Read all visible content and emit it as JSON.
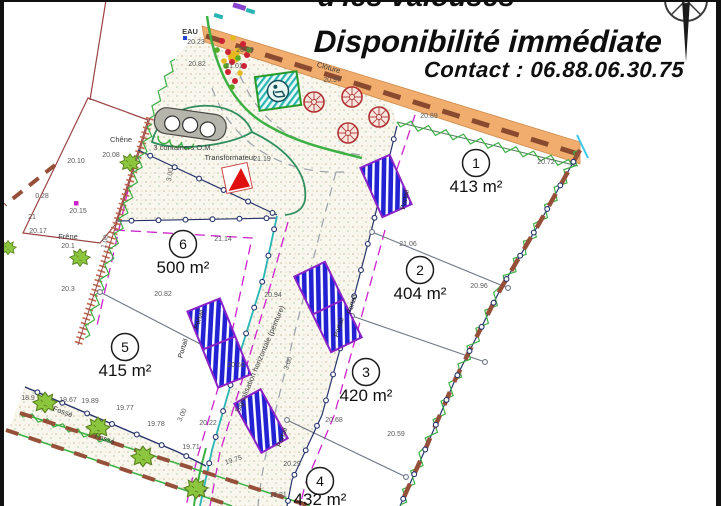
{
  "header": {
    "line1": "d'les valouses",
    "line2": "Disponibilité immédiate",
    "contact": "Contact : 06.88.06.30.75"
  },
  "colors": {
    "road_band": "#f0ad6e",
    "hedge_green": "#3cb043",
    "gate_blue": "#2222d4",
    "gate_border": "#8a22c8",
    "setback_magenta": "#cc22cc",
    "curb_teal": "#2ab5b5",
    "tree_red": "#b03030",
    "transformer_red": "#e01010",
    "fence_brown": "#96503a",
    "boundary_navy": "#26336b"
  },
  "plan": {
    "lots": [
      {
        "num": "1",
        "area": "413 m²",
        "cx": 476,
        "cy": 163,
        "tx": 476,
        "ty": 192
      },
      {
        "num": "2",
        "area": "404 m²",
        "cx": 420,
        "cy": 270,
        "tx": 420,
        "ty": 299
      },
      {
        "num": "3",
        "area": "420 m²",
        "cx": 366,
        "cy": 372,
        "tx": 366,
        "ty": 401
      },
      {
        "num": "4",
        "area": "432 m²",
        "cx": 320,
        "cy": 481,
        "tx": 320,
        "ty": 505
      },
      {
        "num": "5",
        "area": "415 m²",
        "cx": 125,
        "cy": 347,
        "tx": 125,
        "ty": 376
      },
      {
        "num": "6",
        "area": "500 m²",
        "cx": 183,
        "cy": 244,
        "tx": 183,
        "ty": 273
      }
    ],
    "measurements": [
      {
        "t": "20.89",
        "x": 245,
        "y": 52
      },
      {
        "t": "20.23",
        "x": 196,
        "y": 44
      },
      {
        "t": "20.82",
        "x": 197,
        "y": 66
      },
      {
        "t": "21.01",
        "x": 234,
        "y": 68
      },
      {
        "t": "20.97",
        "x": 332,
        "y": 82
      },
      {
        "t": "20.89",
        "x": 429,
        "y": 118
      },
      {
        "t": "20.72",
        "x": 546,
        "y": 164
      },
      {
        "t": "20.10",
        "x": 76,
        "y": 163
      },
      {
        "t": "20.08",
        "x": 111,
        "y": 157
      },
      {
        "t": "0.28",
        "x": 42,
        "y": 198
      },
      {
        "t": "20.15",
        "x": 78,
        "y": 213
      },
      {
        "t": "21",
        "x": 32,
        "y": 219
      },
      {
        "t": "20.17",
        "x": 38,
        "y": 233
      },
      {
        "t": "20.1",
        "x": 68,
        "y": 248
      },
      {
        "t": "21.14",
        "x": 223,
        "y": 241
      },
      {
        "t": "21.19",
        "x": 262,
        "y": 161
      },
      {
        "t": "21.06",
        "x": 408,
        "y": 246
      },
      {
        "t": "20.96",
        "x": 479,
        "y": 288
      },
      {
        "t": "20.82",
        "x": 163,
        "y": 296
      },
      {
        "t": "20.94",
        "x": 273,
        "y": 297
      },
      {
        "t": "20.3",
        "x": 68,
        "y": 291
      },
      {
        "t": "20.60",
        "x": 236,
        "y": 367
      },
      {
        "t": "20.68",
        "x": 334,
        "y": 422
      },
      {
        "t": "20.59",
        "x": 396,
        "y": 436
      },
      {
        "t": "20.29",
        "x": 292,
        "y": 466
      },
      {
        "t": "19.81",
        "x": 278,
        "y": 497
      },
      {
        "t": "18.9",
        "x": 28,
        "y": 400
      },
      {
        "t": "19.67",
        "x": 68,
        "y": 402
      },
      {
        "t": "19.89",
        "x": 90,
        "y": 403
      },
      {
        "t": "19.77",
        "x": 125,
        "y": 410
      },
      {
        "t": "19.78",
        "x": 156,
        "y": 426
      },
      {
        "t": "20.22",
        "x": 208,
        "y": 425
      },
      {
        "t": "19.71",
        "x": 191,
        "y": 449
      },
      {
        "t": "19.75",
        "x": 234,
        "y": 462,
        "r": -18
      },
      {
        "t": "1.00",
        "x": 107,
        "y": 242,
        "r": -75,
        "c": "#cc22cc"
      },
      {
        "t": "3.00",
        "x": 172,
        "y": 175,
        "r": -80,
        "c": "#cc22cc"
      },
      {
        "t": "3.00",
        "x": 290,
        "y": 364,
        "r": -72,
        "c": "#cc22cc"
      },
      {
        "t": "3.00",
        "x": 184,
        "y": 416,
        "r": -65,
        "c": "#cc22cc"
      }
    ],
    "labels": [
      {
        "t": "EAU",
        "x": 190,
        "y": 34,
        "c": "#2244cc",
        "b": 1
      },
      {
        "t": "Clôture",
        "x": 328,
        "y": 70,
        "r": 16
      },
      {
        "t": "Transformateur",
        "x": 230,
        "y": 160,
        "c": "#cc2222"
      },
      {
        "t": "3 containers O.M.",
        "x": 183,
        "y": 150
      },
      {
        "t": "Chêne",
        "x": 121,
        "y": 142
      },
      {
        "t": "Frêne",
        "x": 68,
        "y": 239
      },
      {
        "t": "Fossé",
        "x": 62,
        "y": 414,
        "r": 20
      },
      {
        "t": "Fossé",
        "x": 104,
        "y": 441,
        "r": 20
      },
      {
        "t": "Signalisation horizontale (peinture)",
        "x": 262,
        "y": 360,
        "r": -67
      }
    ],
    "gate_labels": [
      {
        "t": "Portail",
        "x": 407,
        "y": 200,
        "r": -78
      },
      {
        "t": "Portail",
        "x": 201,
        "y": 320,
        "r": -73
      },
      {
        "t": "Portail",
        "x": 185,
        "y": 349,
        "r": -73
      },
      {
        "t": "Portail",
        "x": 354,
        "y": 305,
        "r": -73
      },
      {
        "t": "Portail",
        "x": 341,
        "y": 328,
        "r": -73
      },
      {
        "t": "Portail",
        "x": 284,
        "y": 438,
        "r": -70
      }
    ]
  }
}
